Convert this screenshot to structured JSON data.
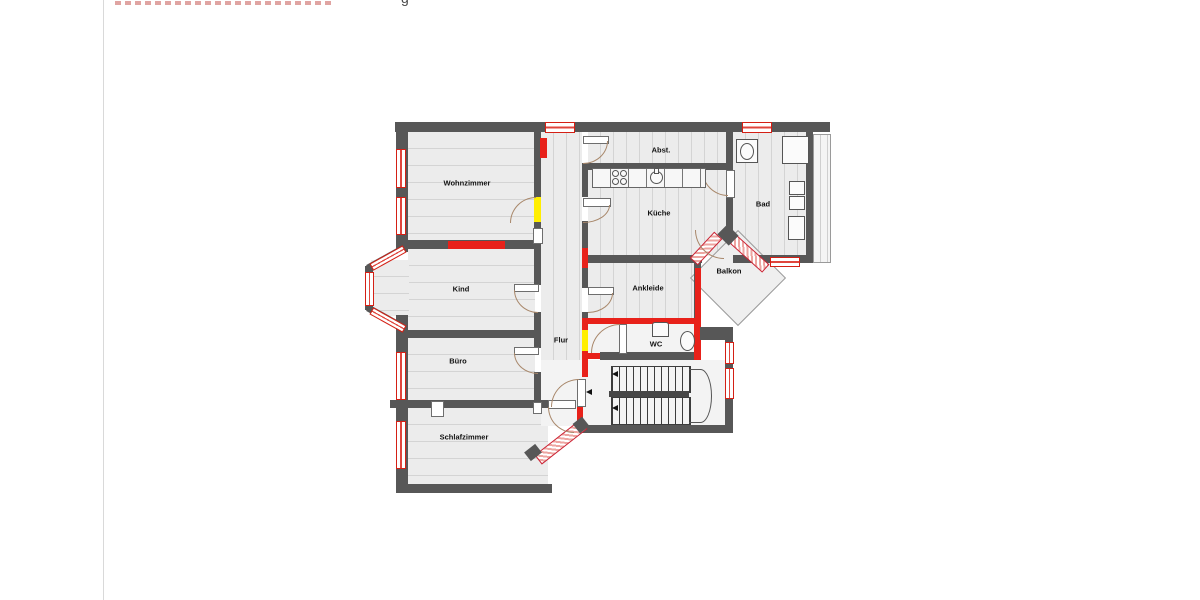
{
  "header": {
    "clipped_caption_visible_fragment": "g"
  },
  "plan": {
    "colors": {
      "wall": "#575757",
      "floor": "#ececec",
      "plank_line": "#d4d4d4",
      "marking_red": "#e8211a",
      "marking_yellow": "#ffee00",
      "door_arc": "#a8876a"
    },
    "rooms": [
      {
        "label": "Wohnzimmer"
      },
      {
        "label": "Kind"
      },
      {
        "label": "Büro"
      },
      {
        "label": "Schlafzimmer"
      },
      {
        "label": "Flur"
      },
      {
        "label": "Küche"
      },
      {
        "label": "Abst."
      },
      {
        "label": "Bad"
      },
      {
        "label": "Ankleide"
      },
      {
        "label": "WC"
      },
      {
        "label": "Balkon"
      }
    ]
  }
}
